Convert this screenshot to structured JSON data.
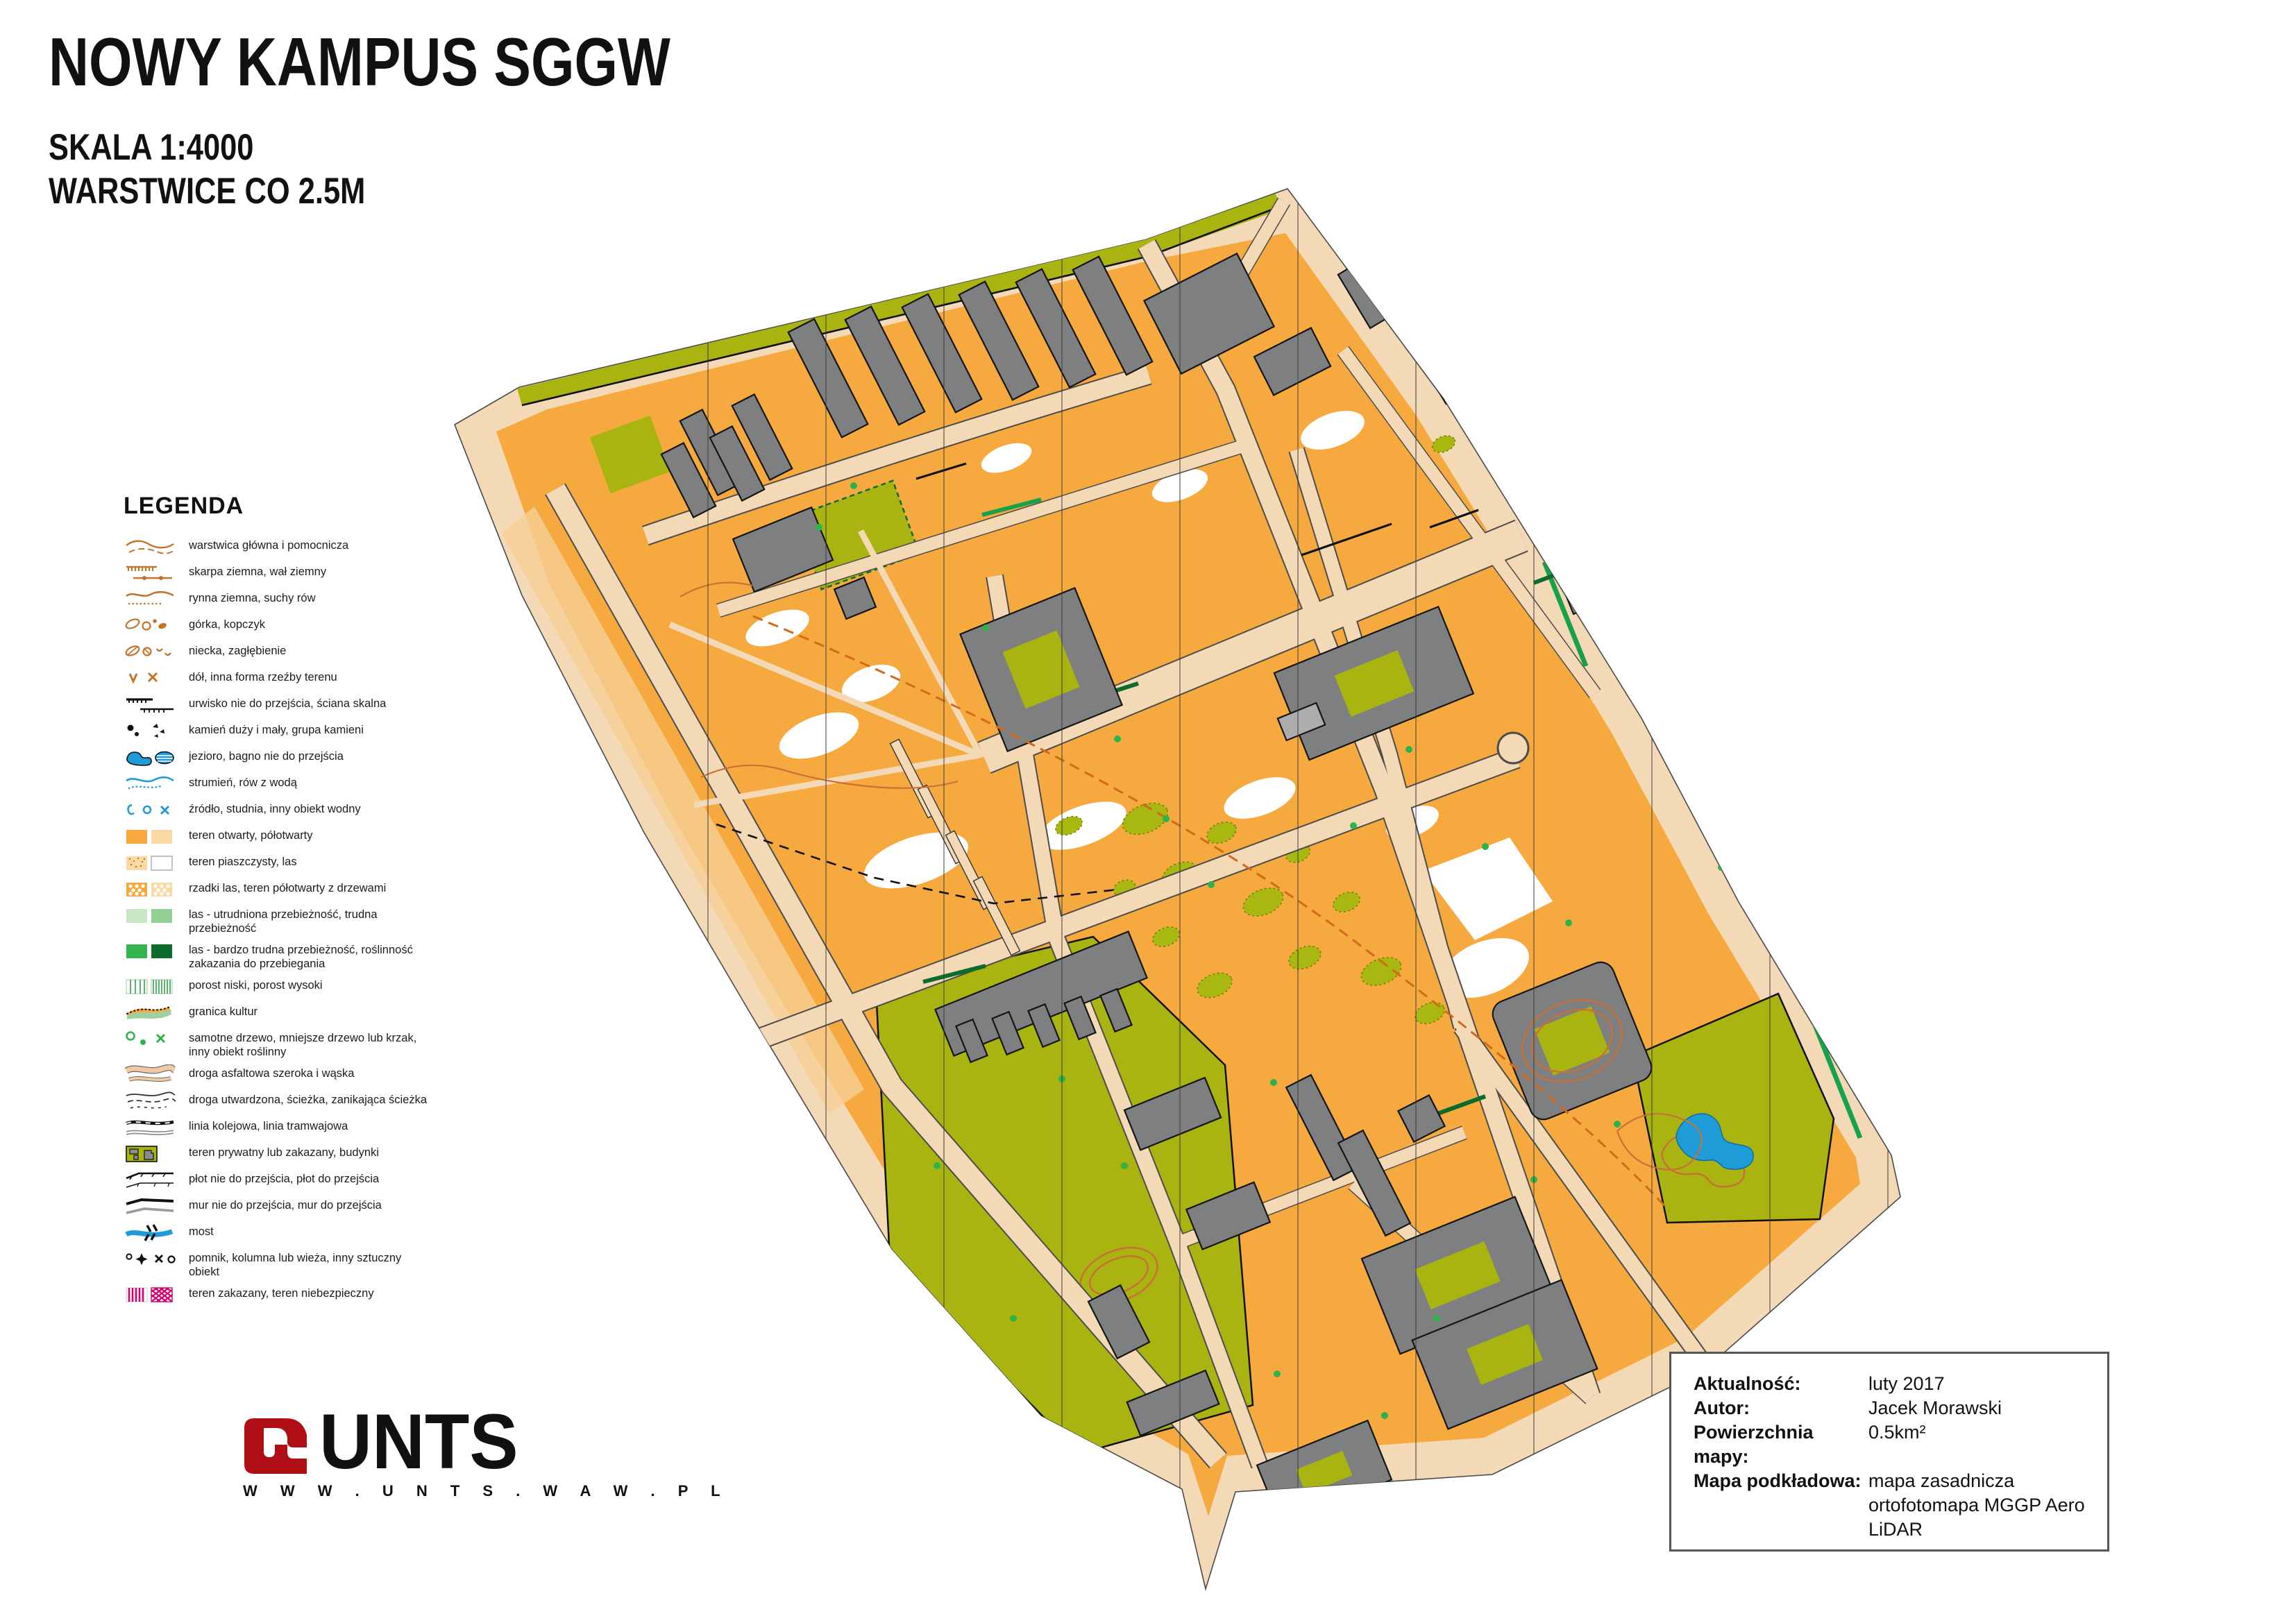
{
  "title": {
    "main": "NOWY KAMPUS SGGW",
    "scale": "SKALA 1:4000",
    "contours": "WARSTWICE CO 2.5M"
  },
  "legend": {
    "heading": "LEGENDA",
    "items": [
      {
        "icon": "contour-icon",
        "label": "warstwica główna i pomocnicza"
      },
      {
        "icon": "earth-bank-icon",
        "label": "skarpa ziemna, wał ziemny"
      },
      {
        "icon": "erosion-gully-icon",
        "label": "rynna ziemna, suchy rów"
      },
      {
        "icon": "knoll-icon",
        "label": "górka, kopczyk"
      },
      {
        "icon": "depression-icon",
        "label": "niecka, zagłębienie"
      },
      {
        "icon": "pit-icon",
        "label": "dół, inna forma rzeźby terenu"
      },
      {
        "icon": "cliff-icon",
        "label": "urwisko nie do przejścia, ściana skalna"
      },
      {
        "icon": "boulder-icon",
        "label": "kamień duży i mały, grupa kamieni"
      },
      {
        "icon": "lake-marsh-icon",
        "label": "jezioro, bagno nie do przejścia"
      },
      {
        "icon": "stream-icon",
        "label": "strumień, rów z wodą"
      },
      {
        "icon": "water-feature-icon",
        "label": "źródło, studnia, inny obiekt wodny"
      },
      {
        "icon": "open-land-icon",
        "label": "teren otwarty, półotwarty"
      },
      {
        "icon": "sandy-ground-icon",
        "label": "teren piaszczysty, las"
      },
      {
        "icon": "scattered-trees-icon",
        "label": "rzadki las, teren półotwarty z drzewami"
      },
      {
        "icon": "forest-slow-icon",
        "label": "las - utrudniona przebieżność, trudna przebieżność"
      },
      {
        "icon": "forest-fight-icon",
        "label": "las - bardzo trudna przebieżność, roślinność zakazania do przebiegania"
      },
      {
        "icon": "vegetation-strip-icon",
        "label": "porost niski, porost wysoki"
      },
      {
        "icon": "cultivation-boundary-icon",
        "label": "granica kultur"
      },
      {
        "icon": "tree-icon",
        "label": "samotne drzewo, mniejsze drzewo lub krzak, inny obiekt roślinny"
      },
      {
        "icon": "paved-road-icon",
        "label": "droga asfaltowa szeroka i wąska"
      },
      {
        "icon": "footpath-icon",
        "label": "droga utwardzona, ścieżka, zanikająca ścieżka"
      },
      {
        "icon": "railway-icon",
        "label": "linia kolejowa, linia tramwajowa"
      },
      {
        "icon": "private-area-icon",
        "label": "teren prywatny lub zakazany, budynki"
      },
      {
        "icon": "fence-icon",
        "label": "płot nie do przejścia, płot do przejścia"
      },
      {
        "icon": "wall-icon",
        "label": "mur nie do przejścia, mur do przejścia"
      },
      {
        "icon": "bridge-icon",
        "label": "most"
      },
      {
        "icon": "monument-icon",
        "label": "pomnik, kolumna lub wieża, inny sztuczny obiekt"
      },
      {
        "icon": "forbidden-area-icon",
        "label": "teren zakazany, teren niebezpieczny"
      }
    ]
  },
  "logo": {
    "name": "UNTS",
    "url": "W W W . U N T S . W A W . P L"
  },
  "info": {
    "rows": [
      {
        "label": "Aktualność:",
        "value": "luty 2017"
      },
      {
        "label": "Autor:",
        "value": "Jacek Morawski"
      },
      {
        "label": "Powierzchnia mapy:",
        "value": "0.5km²"
      },
      {
        "label": "Mapa podkładowa:",
        "value": "mapa zasadnicza\nortofotomapa MGGP Aero\nLiDAR"
      }
    ]
  },
  "colors": {
    "open_orange": "#F5A93E",
    "paved_tan": "#F3D9B6",
    "olive_forbidden": "#A9B411",
    "building_gray": "#7E7F80",
    "water_blue": "#1F9CD8",
    "symbol_brown": "#C4732A",
    "green_strip": "#18A14C",
    "dark_green": "#0C6B2D",
    "forbidden_magenta": "#D4006F",
    "logo_red": "#B01015"
  }
}
